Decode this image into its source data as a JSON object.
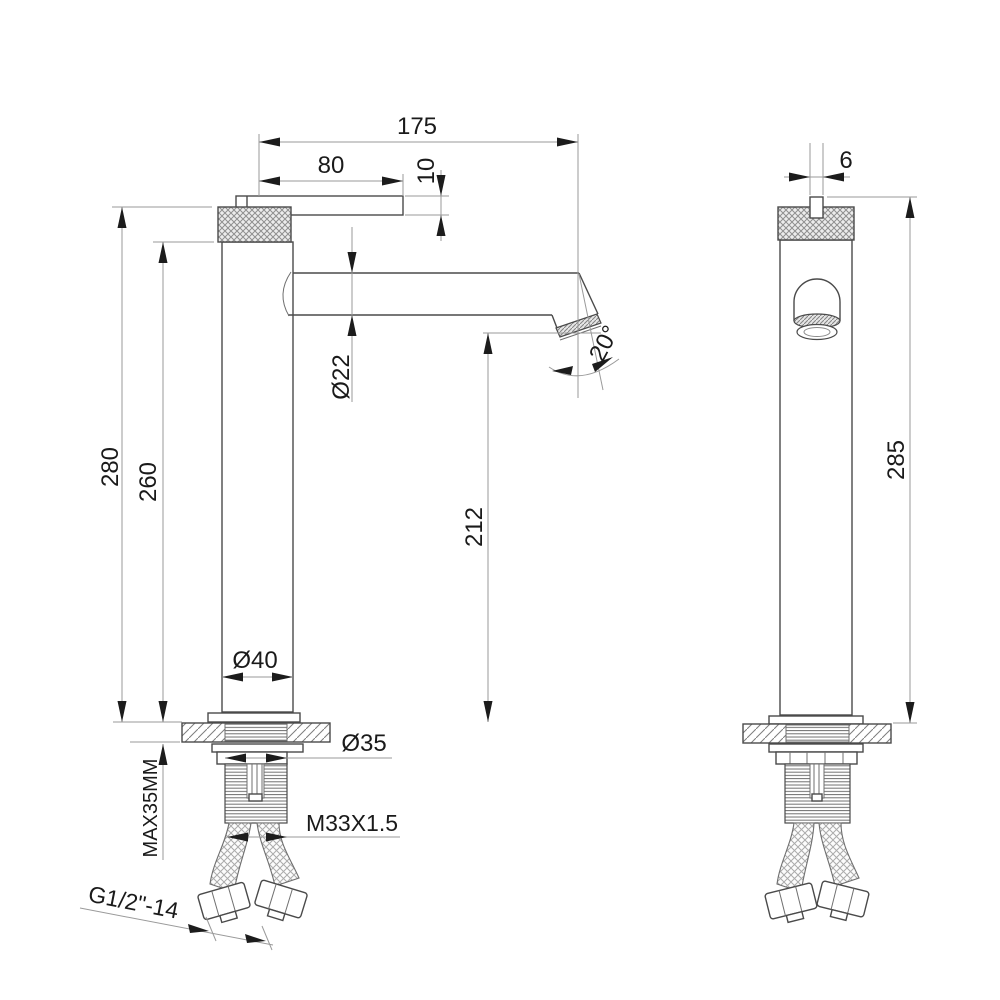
{
  "views": {
    "side": {
      "dims": {
        "total_reach": "175",
        "handle_length": "80",
        "handle_thickness": "10",
        "spout_tube_diameter": "Ø22",
        "spout_angle": "20°",
        "overall_height": "280",
        "height_under_handle": "260",
        "outlet_height": "212",
        "body_diameter": "Ø40",
        "shank_diameter": "Ø35",
        "max_mounting_thickness": "MAX35MM",
        "mounting_thread": "M33X1.5",
        "hose_connection": "G1/2\"-14"
      }
    },
    "front": {
      "dims": {
        "handle_width": "6",
        "overall_height": "285"
      }
    }
  }
}
